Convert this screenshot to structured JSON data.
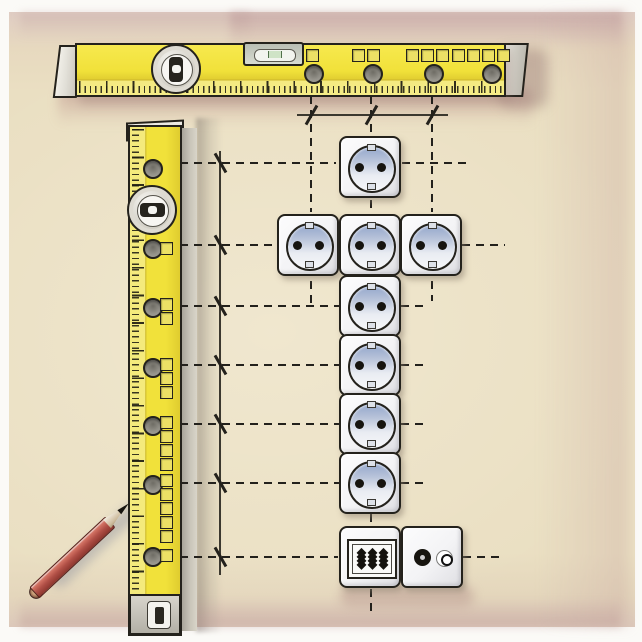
{
  "scene": {
    "palette": {
      "frame": "#fbfaf7",
      "wall": "#eadfc2",
      "wall_shadow_pink": "#ba9496",
      "level_yellow": "#f1e13a",
      "level_yellow_pale": "#f4ea7c",
      "outline": "#24221c",
      "plate_white": "#f3f3f5",
      "recess_blue": "#93a6cb",
      "pin_black": "#16140f",
      "pencil_red": "#b04f46",
      "guide_black": "#23211c",
      "metal_grey": "#c9c5b9"
    },
    "horizontal_level": {
      "hole_cy": 72,
      "hole_centers_x": [
        312,
        371,
        432,
        490
      ],
      "square_groups": [
        {
          "x": 306,
          "count": 1
        },
        {
          "x": 352,
          "count": 2
        },
        {
          "x": 406,
          "count": 3
        },
        {
          "x": 452,
          "count": 4
        }
      ]
    },
    "vertical_level": {
      "hole_cx": 151,
      "hole_centers_y": [
        167,
        247,
        306,
        366,
        424,
        483,
        555
      ],
      "square_groups": [
        {
          "y": 242,
          "count": 1
        },
        {
          "y": 298,
          "count": 2
        },
        {
          "y": 358,
          "count": 3
        },
        {
          "y": 416,
          "count": 4
        },
        {
          "y": 474,
          "count": 5
        },
        {
          "y": 549,
          "count": 1
        }
      ]
    },
    "outlets": [
      {
        "type": "schuko",
        "x": 370,
        "y": 167
      },
      {
        "type": "schuko",
        "x": 308,
        "y": 245
      },
      {
        "type": "schuko",
        "x": 370,
        "y": 245
      },
      {
        "type": "schuko",
        "x": 431,
        "y": 245
      },
      {
        "type": "schuko",
        "x": 370,
        "y": 306
      },
      {
        "type": "schuko",
        "x": 370,
        "y": 365
      },
      {
        "type": "schuko",
        "x": 370,
        "y": 424
      },
      {
        "type": "schuko",
        "x": 370,
        "y": 483
      },
      {
        "type": "terminal",
        "x": 370,
        "y": 557
      },
      {
        "type": "tv",
        "x": 432,
        "y": 557
      }
    ],
    "guides": {
      "solid_lines": [
        {
          "dir": "v",
          "x": 220,
          "y": 151,
          "len": 424
        },
        {
          "dir": "h",
          "x": 297,
          "y": 115,
          "len": 151
        }
      ],
      "dashed_lines": [
        {
          "dir": "h",
          "x": 180,
          "y": 163,
          "len": 156
        },
        {
          "dir": "h",
          "x": 402,
          "y": 163,
          "len": 68
        },
        {
          "dir": "h",
          "x": 180,
          "y": 245,
          "len": 98
        },
        {
          "dir": "h",
          "x": 462,
          "y": 245,
          "len": 43
        },
        {
          "dir": "h",
          "x": 180,
          "y": 306,
          "len": 159
        },
        {
          "dir": "h",
          "x": 401,
          "y": 306,
          "len": 28
        },
        {
          "dir": "h",
          "x": 180,
          "y": 365,
          "len": 159
        },
        {
          "dir": "h",
          "x": 401,
          "y": 365,
          "len": 28
        },
        {
          "dir": "h",
          "x": 180,
          "y": 424,
          "len": 159
        },
        {
          "dir": "h",
          "x": 401,
          "y": 424,
          "len": 28
        },
        {
          "dir": "h",
          "x": 180,
          "y": 483,
          "len": 159
        },
        {
          "dir": "h",
          "x": 401,
          "y": 483,
          "len": 28
        },
        {
          "dir": "h",
          "x": 180,
          "y": 557,
          "len": 158
        },
        {
          "dir": "h",
          "x": 463,
          "y": 557,
          "len": 42
        },
        {
          "dir": "v",
          "x": 311,
          "y": 96,
          "len": 116
        },
        {
          "dir": "v",
          "x": 311,
          "y": 281,
          "len": 22
        },
        {
          "dir": "v",
          "x": 371,
          "y": 96,
          "len": 39
        },
        {
          "dir": "v",
          "x": 371,
          "y": 200,
          "len": 13
        },
        {
          "dir": "v",
          "x": 371,
          "y": 514,
          "len": 13
        },
        {
          "dir": "v",
          "x": 371,
          "y": 589,
          "len": 23
        },
        {
          "dir": "v",
          "x": 432,
          "y": 96,
          "len": 116
        },
        {
          "dir": "v",
          "x": 432,
          "y": 281,
          "len": 20
        }
      ],
      "cross_ticks": [
        {
          "x": 220,
          "y": 163,
          "slant": "back"
        },
        {
          "x": 220,
          "y": 245,
          "slant": "back"
        },
        {
          "x": 220,
          "y": 306,
          "slant": "back"
        },
        {
          "x": 220,
          "y": 365,
          "slant": "back"
        },
        {
          "x": 220,
          "y": 424,
          "slant": "back"
        },
        {
          "x": 220,
          "y": 483,
          "slant": "back"
        },
        {
          "x": 220,
          "y": 557,
          "slant": "back"
        },
        {
          "x": 311,
          "y": 115,
          "slant": "fwd"
        },
        {
          "x": 371,
          "y": 115,
          "slant": "fwd"
        },
        {
          "x": 432,
          "y": 115,
          "slant": "fwd"
        }
      ]
    },
    "pencil": {
      "x": 30,
      "y": 595,
      "length": 135,
      "angle_deg": -43
    }
  }
}
